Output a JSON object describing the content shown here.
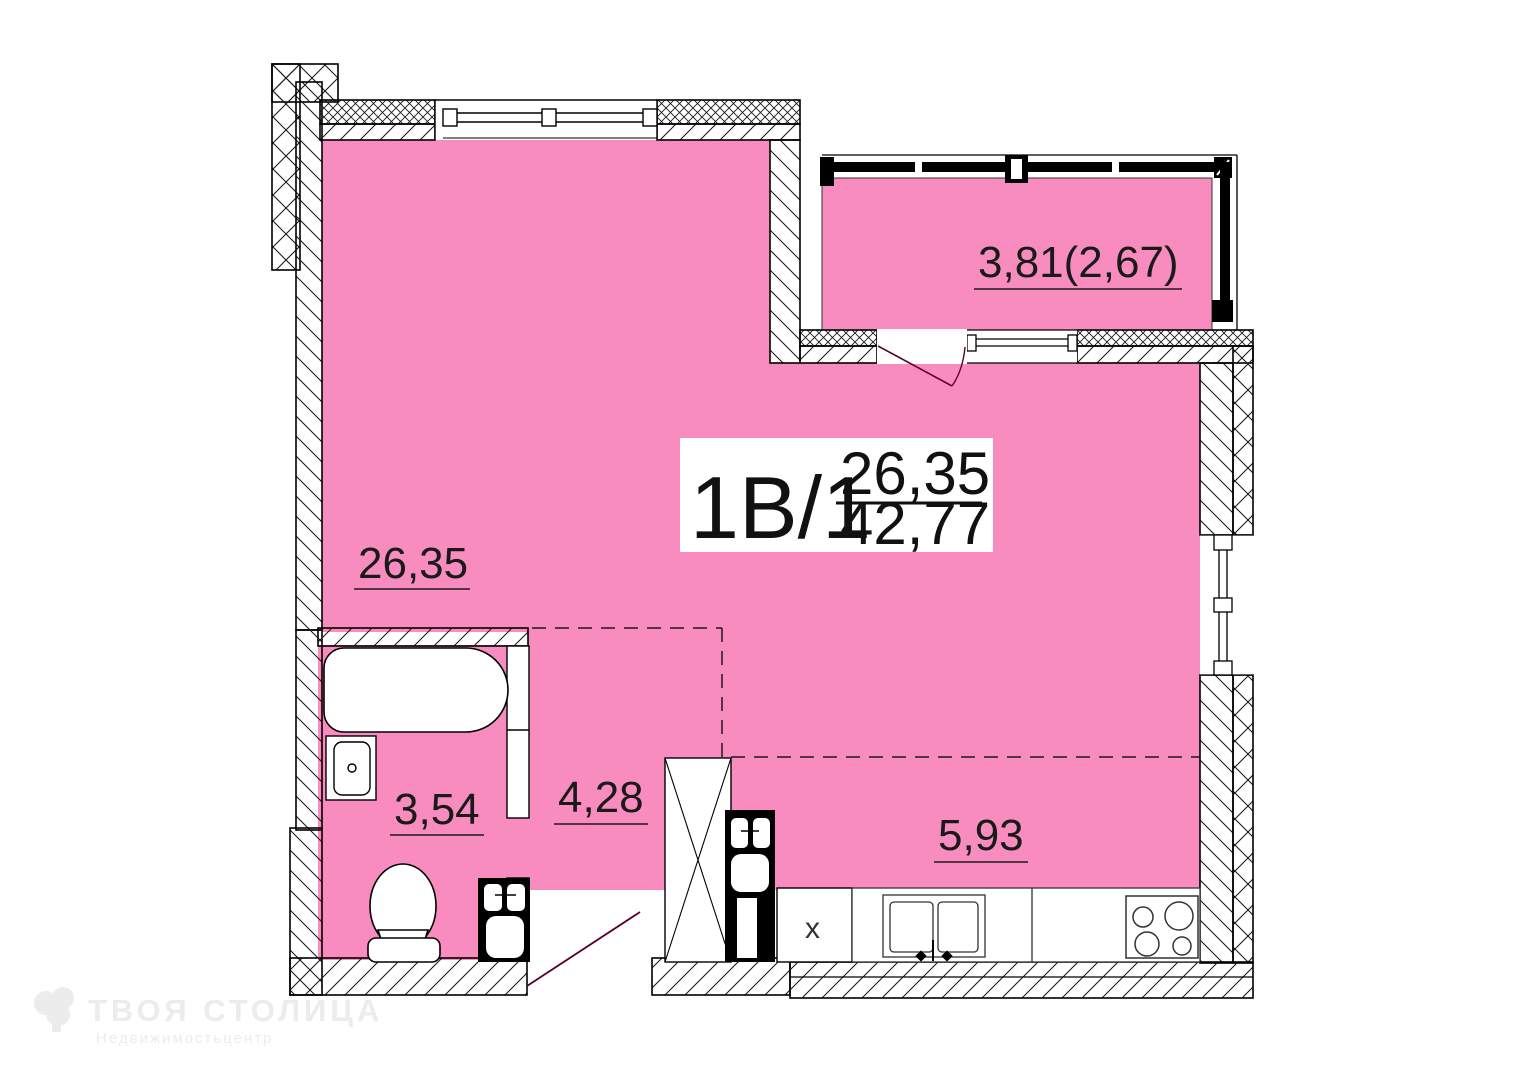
{
  "title_block": {
    "unit": "1В/1",
    "area_upper": "26,35",
    "area_lower": "42,77"
  },
  "labels": {
    "living": "26,35",
    "balcony": "3,81(2,67)",
    "bathroom": "3,54",
    "hallway": "4,28",
    "kitchen": "5,93"
  },
  "washer_mark": "x",
  "watermark": {
    "brand": "ТВОЯ СТОЛИЦА",
    "sub": "Недвижимостьцентр"
  },
  "colors": {
    "room_fill": "#F98CBE",
    "line": "#000000",
    "watermark": "#ececec"
  }
}
